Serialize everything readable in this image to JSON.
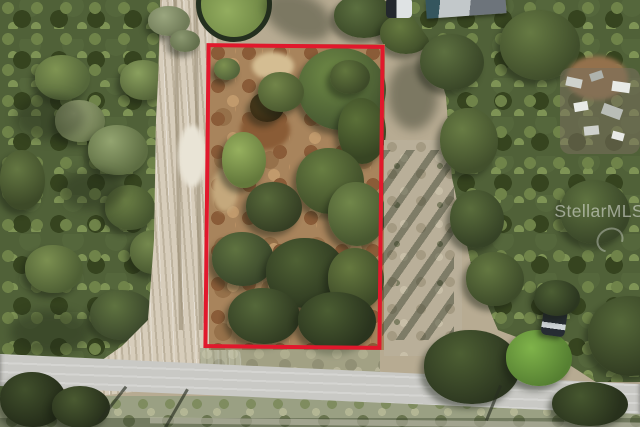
{
  "page": {
    "type": "aerial-photograph",
    "subject": "Drone aerial view of a vacant wooded land parcel outlined with a red boundary rectangle, bordered by a dirt road on the left and a paved road at the bottom",
    "width_px": 640,
    "height_px": 427
  },
  "watermark": {
    "text": "StellarMLS",
    "style": "semi-transparent white overlay, right edge of photo"
  },
  "annotation": {
    "name": "parcel-boundary",
    "shape": "rectangle",
    "color": "#e1182c",
    "stroke_px": 4
  },
  "colors": {
    "accent-red": "#e1182c",
    "watermark-white": "rgba(255,255,255,0.48)",
    "forest-green": "#506138",
    "dirt-road-tan": "#d7cdbb",
    "lot-soil-brown": "#a8845c",
    "paved-road-gray": "#c9c9c5",
    "dry-ground-pale": "#b9af99"
  },
  "scene": {
    "elements": [
      "dense forest on left side",
      "sandy dirt road running top-to-bottom-left",
      "paved road across the bottom",
      "red-outlined vacant lot with bare soil and tree clusters",
      "small round pond/tree mound at top center",
      "building roof at top right",
      "debris pile on right side",
      "dark parked vehicle lower right",
      "utility pole shadows on pavement"
    ]
  }
}
